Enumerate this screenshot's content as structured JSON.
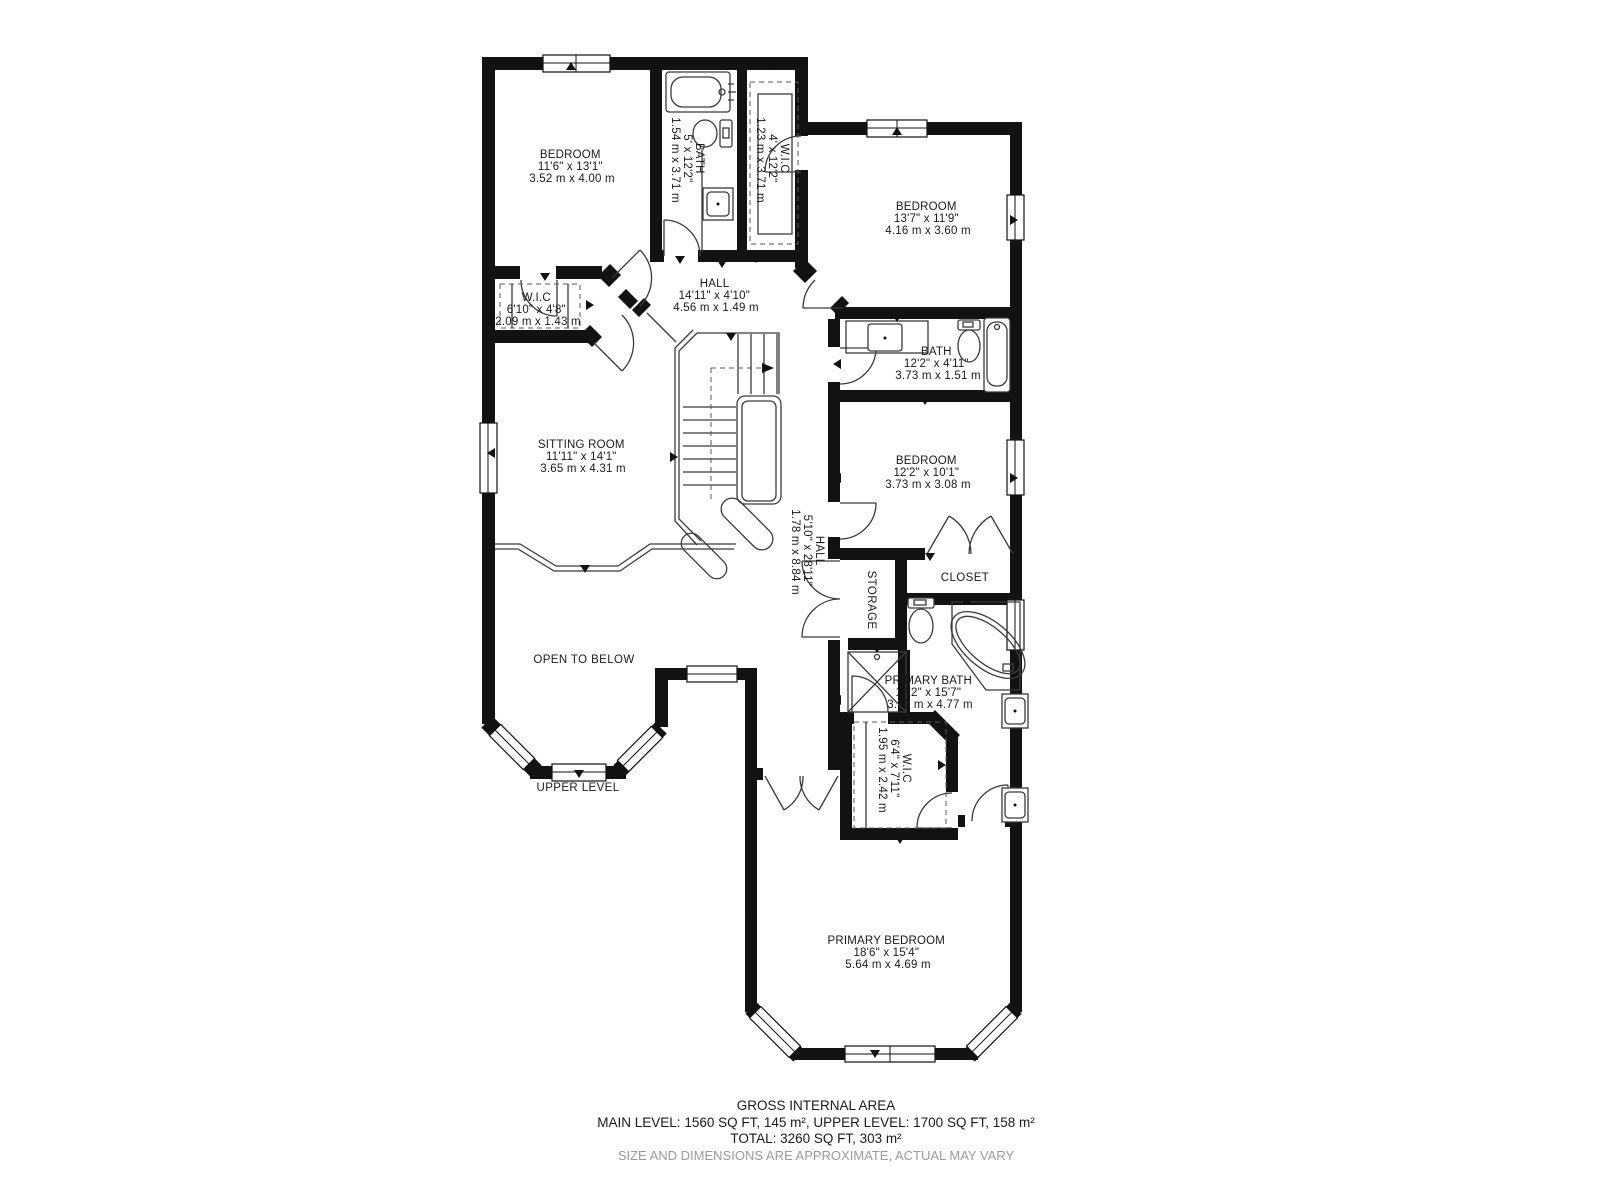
{
  "plan": {
    "rooms": [
      {
        "id": "bedroom-1",
        "name": "BEDROOM",
        "imperial": "11'6\" x 13'1\"",
        "metric": "3.52 m x 4.00 m"
      },
      {
        "id": "bath-top",
        "name": "BATH",
        "imperial": "5' x 12'2\"",
        "metric": "1.54 m x 3.71 m"
      },
      {
        "id": "wic-top",
        "name": "W.I.C",
        "imperial": "4' x 12'2\"",
        "metric": "1.23 m x 3.71 m"
      },
      {
        "id": "bedroom-2",
        "name": "BEDROOM",
        "imperial": "13'7\" x 11'9\"",
        "metric": "4.16 m x 3.60 m"
      },
      {
        "id": "hall-top",
        "name": "HALL",
        "imperial": "14'11\" x 4'10\"",
        "metric": "4.56 m x 1.49 m"
      },
      {
        "id": "wic-left",
        "name": "W.I.C",
        "imperial": "6'10\" x 4'8\"",
        "metric": "2.09 m x 1.43 m"
      },
      {
        "id": "bath-mid",
        "name": "BATH",
        "imperial": "12'2\" x 4'11\"",
        "metric": "3.73 m x 1.51 m"
      },
      {
        "id": "sitting-room",
        "name": "SITTING ROOM",
        "imperial": "11'11\" x 14'1\"",
        "metric": "3.65 m x 4.31 m"
      },
      {
        "id": "bedroom-3",
        "name": "BEDROOM",
        "imperial": "12'2\" x 10'1\"",
        "metric": "3.73 m x 3.08 m"
      },
      {
        "id": "hall-vertical",
        "name": "HALL",
        "imperial": "5'10\" x 28'11\"",
        "metric": "1.78 m x 8.84 m"
      },
      {
        "id": "storage",
        "name": "STORAGE"
      },
      {
        "id": "closet",
        "name": "CLOSET"
      },
      {
        "id": "primary-bath",
        "name": "PRIMARY BATH",
        "imperial": "12'2\" x 15'7\"",
        "metric": "3.73 m x 4.77 m"
      },
      {
        "id": "wic-primary",
        "name": "W.I.C",
        "imperial": "6'4\" x 7'11\"",
        "metric": "1.95 m x 2.42 m"
      },
      {
        "id": "open-to-below",
        "name": "OPEN TO BELOW"
      },
      {
        "id": "primary-bedroom",
        "name": "PRIMARY BEDROOM",
        "imperial": "18'6\" x 15'4\"",
        "metric": "5.64 m x 4.69 m"
      }
    ],
    "level_label": "UPPER LEVEL",
    "footer": {
      "title": "GROSS INTERNAL AREA",
      "line1": "MAIN LEVEL: 1560 SQ FT, 145 m², UPPER LEVEL: 1700 SQ FT, 158 m²",
      "line2": "TOTAL: 3260 SQ FT, 303 m²",
      "disclaimer": "SIZE AND DIMENSIONS ARE APPROXIMATE, ACTUAL MAY VARY"
    },
    "colors": {
      "walls": "#121212",
      "background": "#ffffff",
      "text": "#1a1a1a",
      "disclaimer_text": "#9b9b9b"
    }
  }
}
